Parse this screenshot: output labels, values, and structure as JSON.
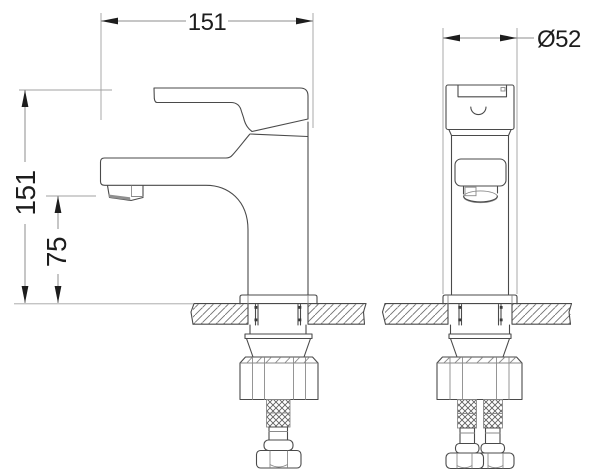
{
  "drawing": {
    "dimensions": {
      "top_width": "151",
      "overall_height": "151",
      "spout_height": "75",
      "diameter": "Ø52"
    },
    "colors": {
      "background": "#ffffff",
      "outline": "#4a4a4a",
      "dimension_line": "#8c8c8c",
      "hatch": "#6f6f6f",
      "text": "#1d1d1d"
    }
  }
}
